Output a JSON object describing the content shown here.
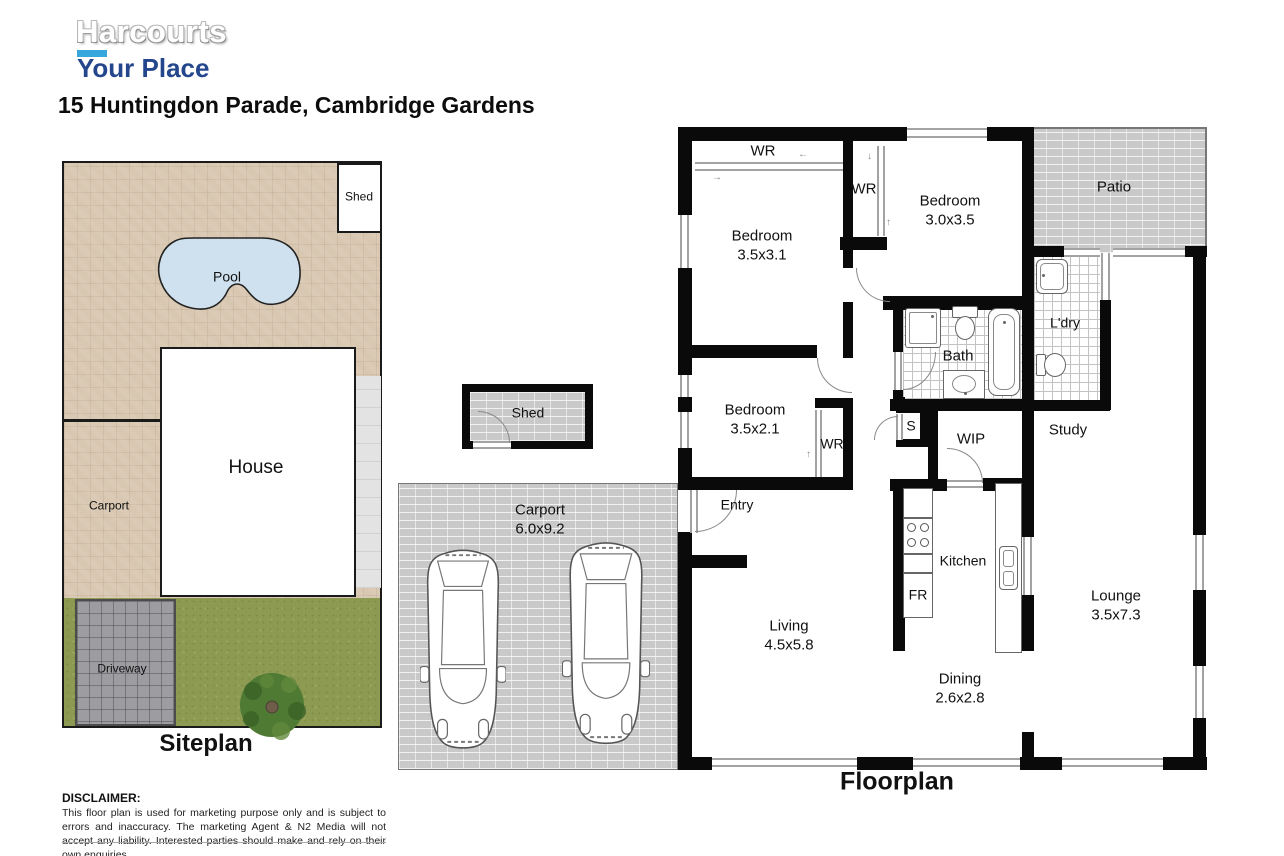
{
  "header": {
    "brand_top": "Harcourts",
    "brand_bottom": "Your Place",
    "address": "15 Huntingdon Parade, Cambridge Gardens"
  },
  "siteplan": {
    "title": "Siteplan",
    "shed": "Shed",
    "pool": "Pool",
    "house": "House",
    "carport": "Carport",
    "driveway": "Driveway"
  },
  "floorplan": {
    "title": "Floorplan",
    "wr": "WR",
    "bedroom1": {
      "name": "Bedroom",
      "size": "3.5x3.1"
    },
    "bedroom2": {
      "name": "Bedroom",
      "size": "3.5x2.1"
    },
    "bedroom3": {
      "name": "Bedroom",
      "size": "3.0x3.5"
    },
    "patio": "Patio",
    "ldry": "L'dry",
    "bath": "Bath",
    "study": "Study",
    "store": "S",
    "wip": "WIP",
    "entry": "Entry",
    "kitchen": "Kitchen",
    "fridge": "FR",
    "shed": "Shed",
    "carport": {
      "name": "Carport",
      "size": "6.0x9.2"
    },
    "living": {
      "name": "Living",
      "size": "4.5x5.8"
    },
    "dining": {
      "name": "Dining",
      "size": "2.6x2.8"
    },
    "lounge": {
      "name": "Lounge",
      "size": "3.5x7.3"
    }
  },
  "icons": {
    "arrow_left": "←",
    "arrow_right": "→",
    "arrow_up": "↑",
    "arrow_down": "↓"
  },
  "disclaimer": {
    "heading": "DISCLAIMER:",
    "body": "This floor plan is used for marketing purpose only and is subject to errors and inaccuracy. The marketing Agent & N2 Media will not accept any liability. Interested parties should make and rely on their own enquiries."
  },
  "colors": {
    "brand_blue": "#24468c",
    "accent_cyan": "#35a7dc",
    "wall": "#0a0a0a",
    "paving_tan": "#d8c7b1",
    "brick_grey": "#c9c9c9",
    "grass_green": "#8d9b52",
    "driveway_grey": "#9d9da1",
    "pool_blue": "#cfe1ee"
  }
}
